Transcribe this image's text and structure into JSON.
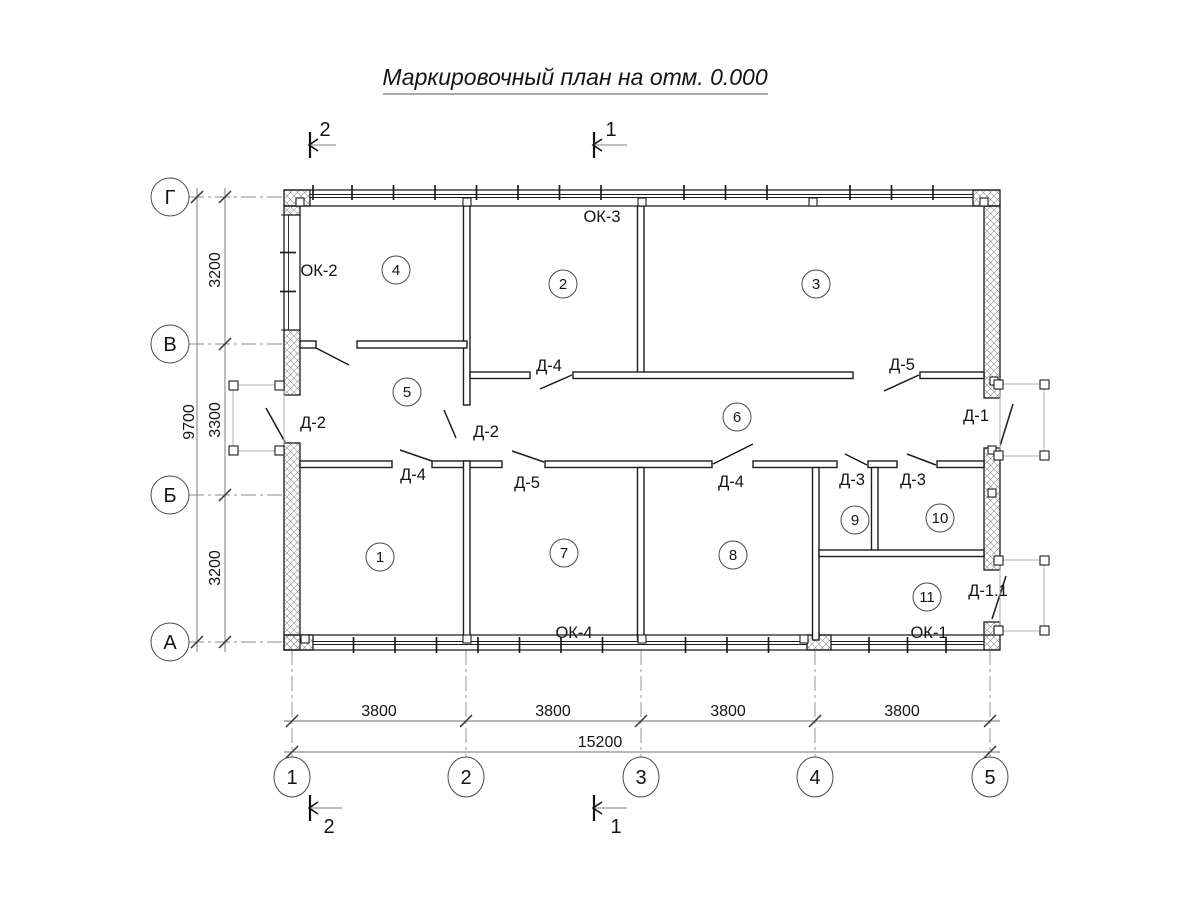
{
  "title": "Маркировочный план на отм. 0.000",
  "axes": {
    "rows": [
      {
        "label": "Г"
      },
      {
        "label": "В"
      },
      {
        "label": "Б"
      },
      {
        "label": "А"
      }
    ],
    "cols": [
      {
        "label": "1"
      },
      {
        "label": "2"
      },
      {
        "label": "3"
      },
      {
        "label": "4"
      },
      {
        "label": "5"
      }
    ]
  },
  "dimensions": {
    "v_segments": [
      "3200",
      "3300",
      "3200"
    ],
    "v_total": "9700",
    "h_segments": [
      "3800",
      "3800",
      "3800",
      "3800"
    ],
    "h_total": "15200"
  },
  "rooms": [
    "1",
    "2",
    "3",
    "4",
    "5",
    "6",
    "7",
    "8",
    "9",
    "10",
    "11"
  ],
  "door_marks": {
    "d1": "Д-1",
    "d1_1": "Д-1.1",
    "d2": "Д-2",
    "d3": "Д-3",
    "d4": "Д-4",
    "d5": "Д-5"
  },
  "window_marks": {
    "ok1": "ОК-1",
    "ok2": "ОК-2",
    "ok3": "ОК-3",
    "ok4": "ОК-4"
  },
  "section_marks": {
    "s1": "1",
    "s2": "2"
  }
}
